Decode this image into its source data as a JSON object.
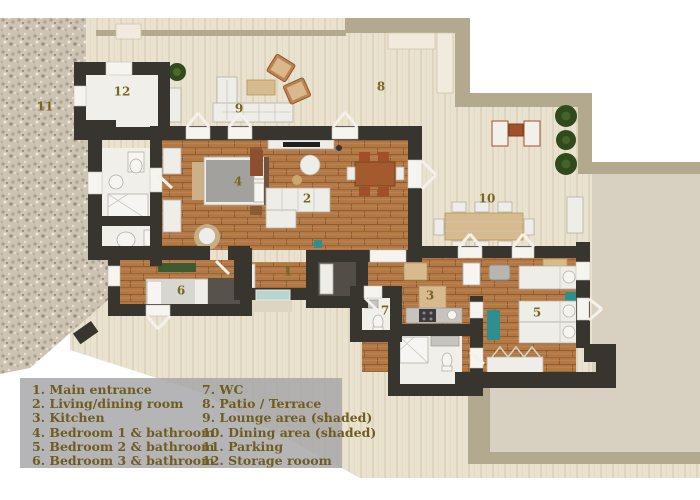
{
  "title": "3D apartment floor plan with patio and legend",
  "legend": {
    "col1": [
      "1. Main entrance",
      "2. Living/dining room",
      "3. Kitchen",
      "4. Bedroom 1 & bathroom",
      "5. Bedroom 2 & bathroom",
      "6. Bedroom 3 & bathroom"
    ],
    "col2": [
      "7. WC",
      "8. Patio / Terrace",
      "9. Lounge area (shaded)",
      "10. Dining area (shaded)",
      "11. Parking",
      "12. Storage rooom"
    ]
  },
  "markers": {
    "m1": "1",
    "m2": "2",
    "m3": "3",
    "m4": "4",
    "m5": "5",
    "m6": "6",
    "m7": "7",
    "m8": "8",
    "m9": "9",
    "m10": "10",
    "m11": "11",
    "m12": "12"
  },
  "colors": {
    "label": "#7a661f",
    "legend_text": "#6e5d1f",
    "legend_bg": "rgba(165,165,167,0.82)",
    "wall": "#38342e",
    "patio_border": "#b3a98f",
    "teal": "#2e8f8f",
    "plant_green": "#2f4a1d"
  }
}
